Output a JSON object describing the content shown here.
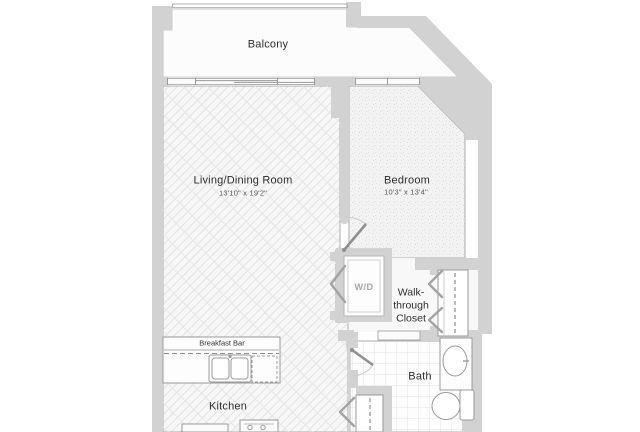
{
  "floorplan": {
    "rooms": {
      "balcony": {
        "label": "Balcony"
      },
      "living_dining": {
        "label": "Living/Dining Room",
        "dimensions": "13'10\" x 19'2\""
      },
      "bedroom": {
        "label": "Bedroom",
        "dimensions": "10'3\" x 13'4\""
      },
      "walk_through_closet": {
        "label": "Walk-through Closet"
      },
      "bath": {
        "label": "Bath"
      },
      "kitchen": {
        "label": "Kitchen"
      }
    },
    "features": {
      "washer_dryer": {
        "label": "W/D"
      },
      "breakfast_bar": {
        "label": "Breakfast Bar"
      }
    },
    "colors": {
      "wall": "#d2d2d2",
      "room_outline": "#a9a9a9",
      "living_floor_hatch": "#e2e2e2",
      "bedroom_carpet_dot": "#dddddd",
      "bath_tile_line": "#e3e3e3",
      "label_text": "#2d2d2d",
      "dimension_text": "#555555"
    }
  }
}
